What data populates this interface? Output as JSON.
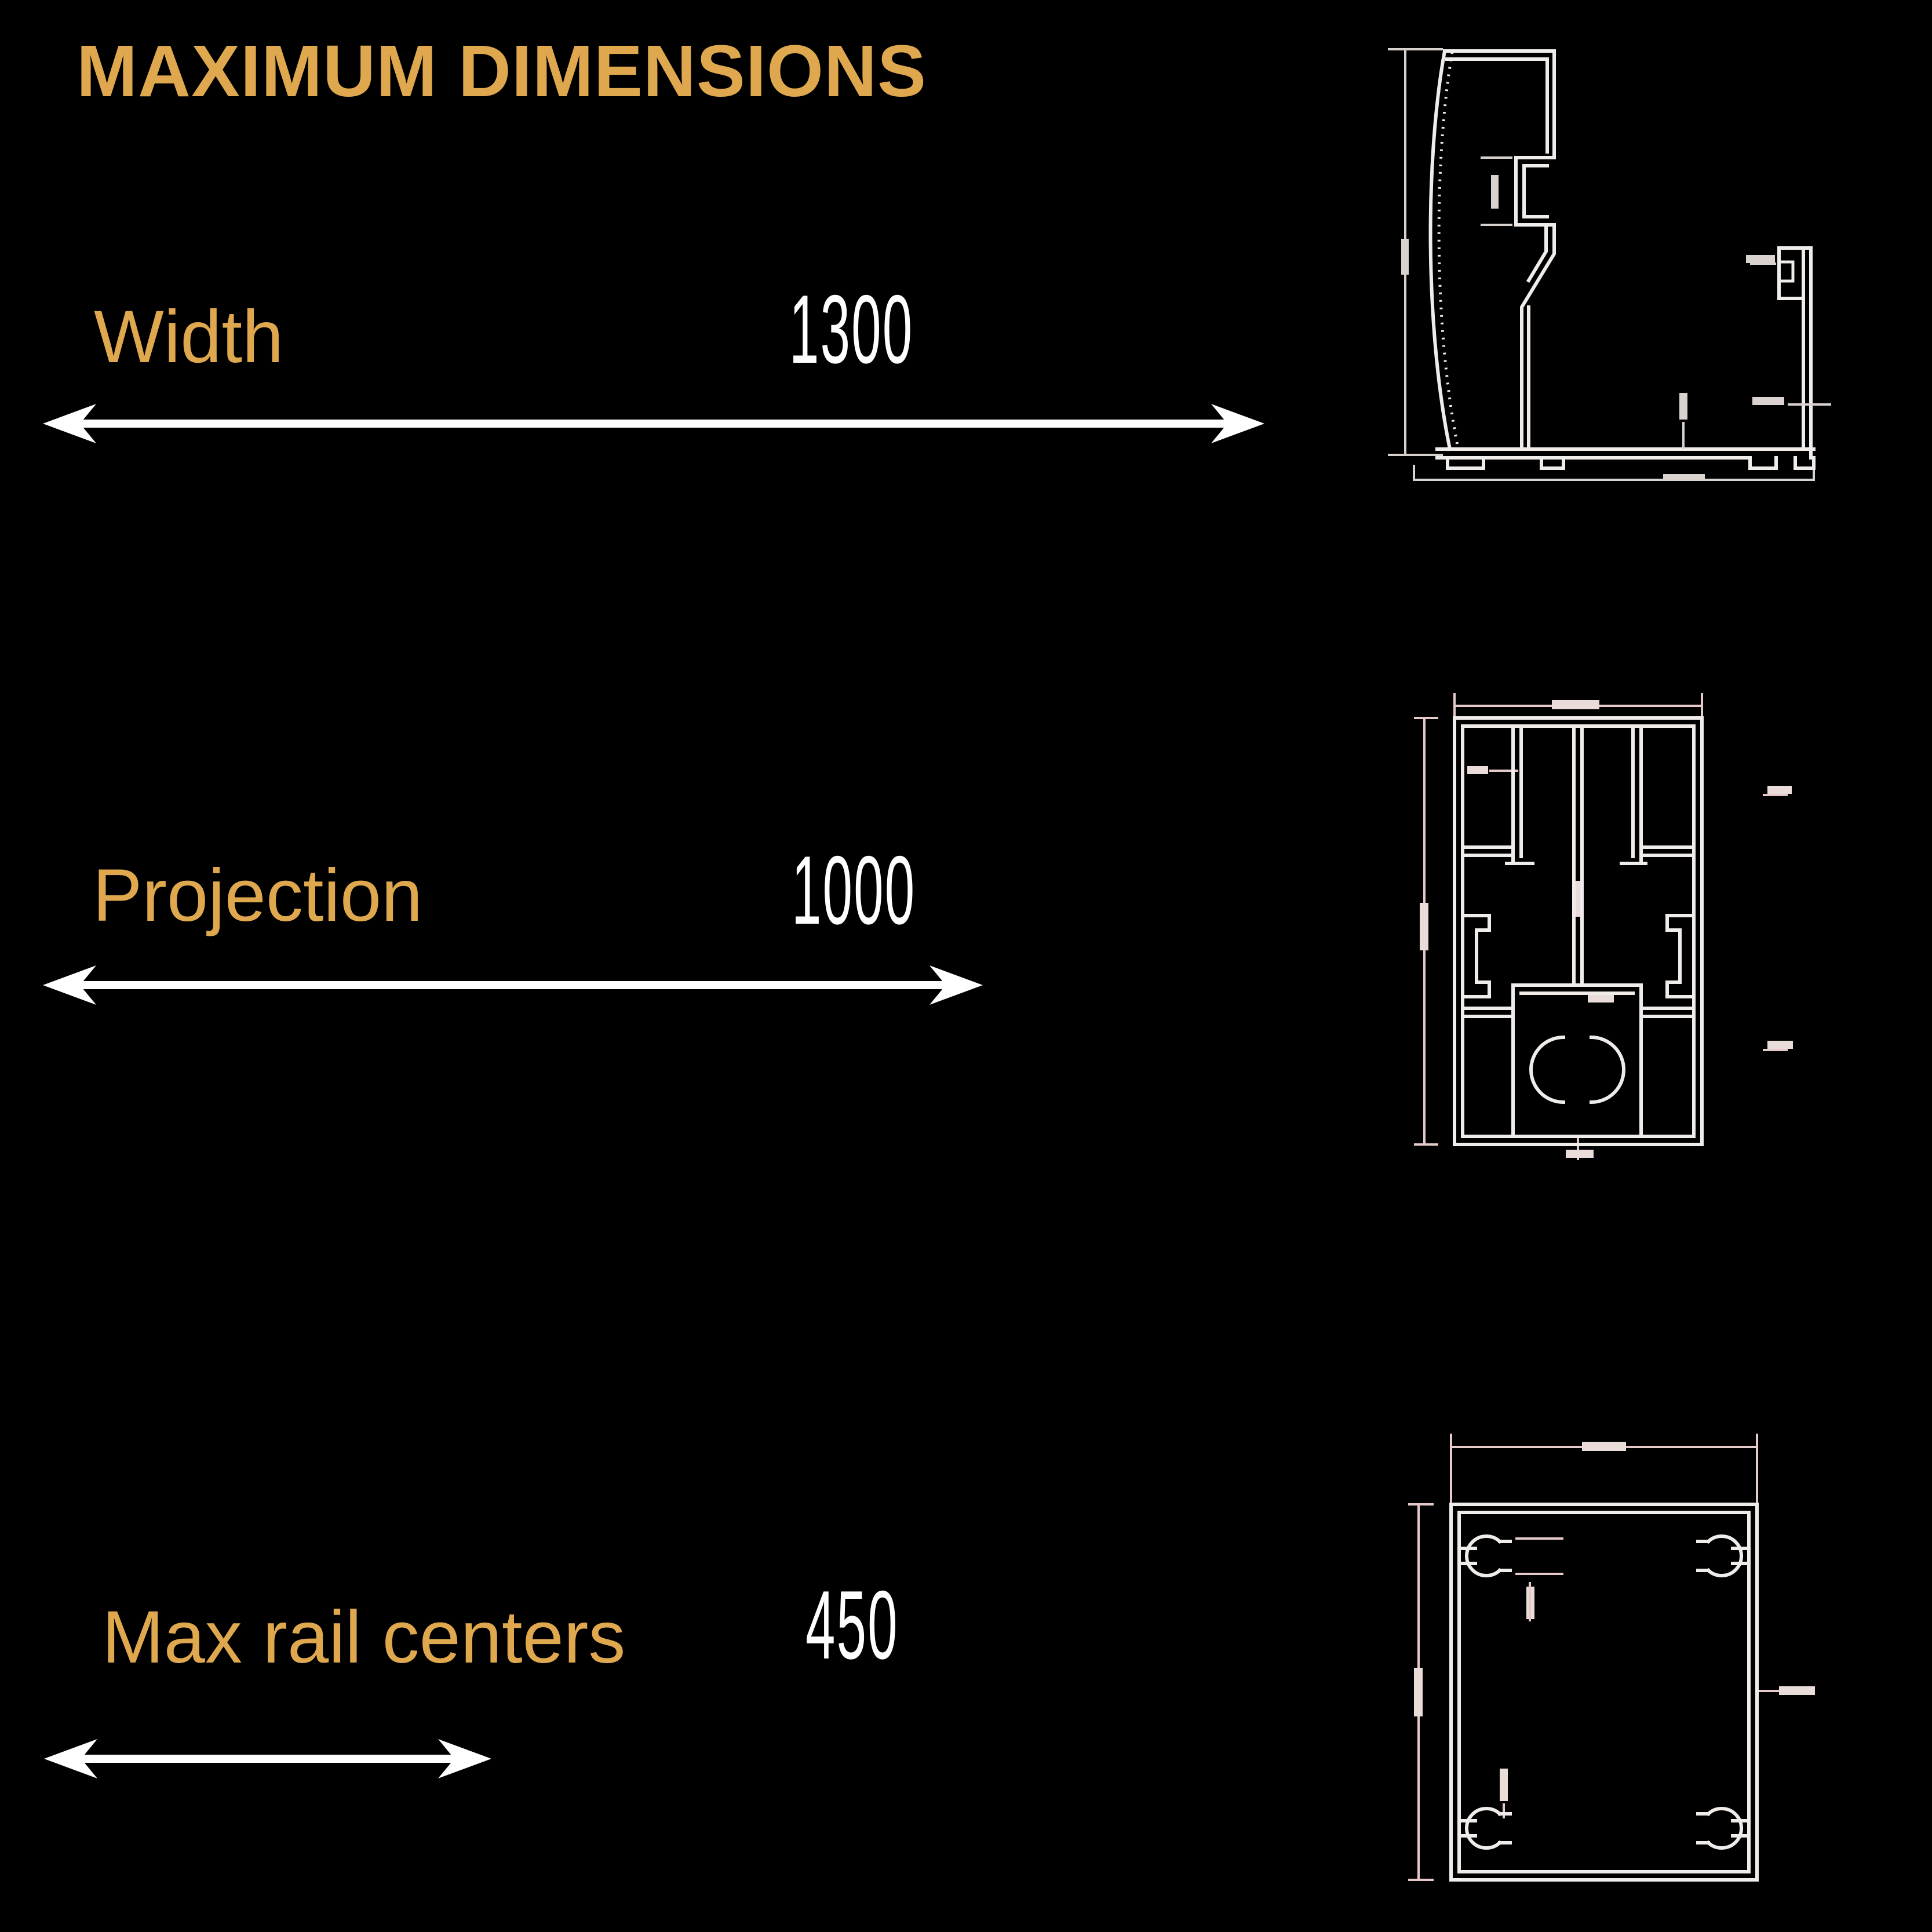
{
  "title": "MAXIMUM DIMENSIONS",
  "rows": [
    {
      "label": "Width",
      "value": "1300"
    },
    {
      "label": "Projection",
      "value": "1000"
    },
    {
      "label": "Max rail centers",
      "value": "450"
    }
  ],
  "colors": {
    "background": "#000000",
    "accent_gold": "#DFA84F",
    "value_white": "#FFFFFF",
    "drawing_line": "#EFECEA",
    "dimension_line_pink": "#E6C9C9"
  },
  "icons": {
    "width_arrow": "double-headed-horizontal-arrow",
    "projection_arrow": "double-headed-horizontal-arrow",
    "rail_centers_arrow": "double-headed-horizontal-arrow"
  }
}
